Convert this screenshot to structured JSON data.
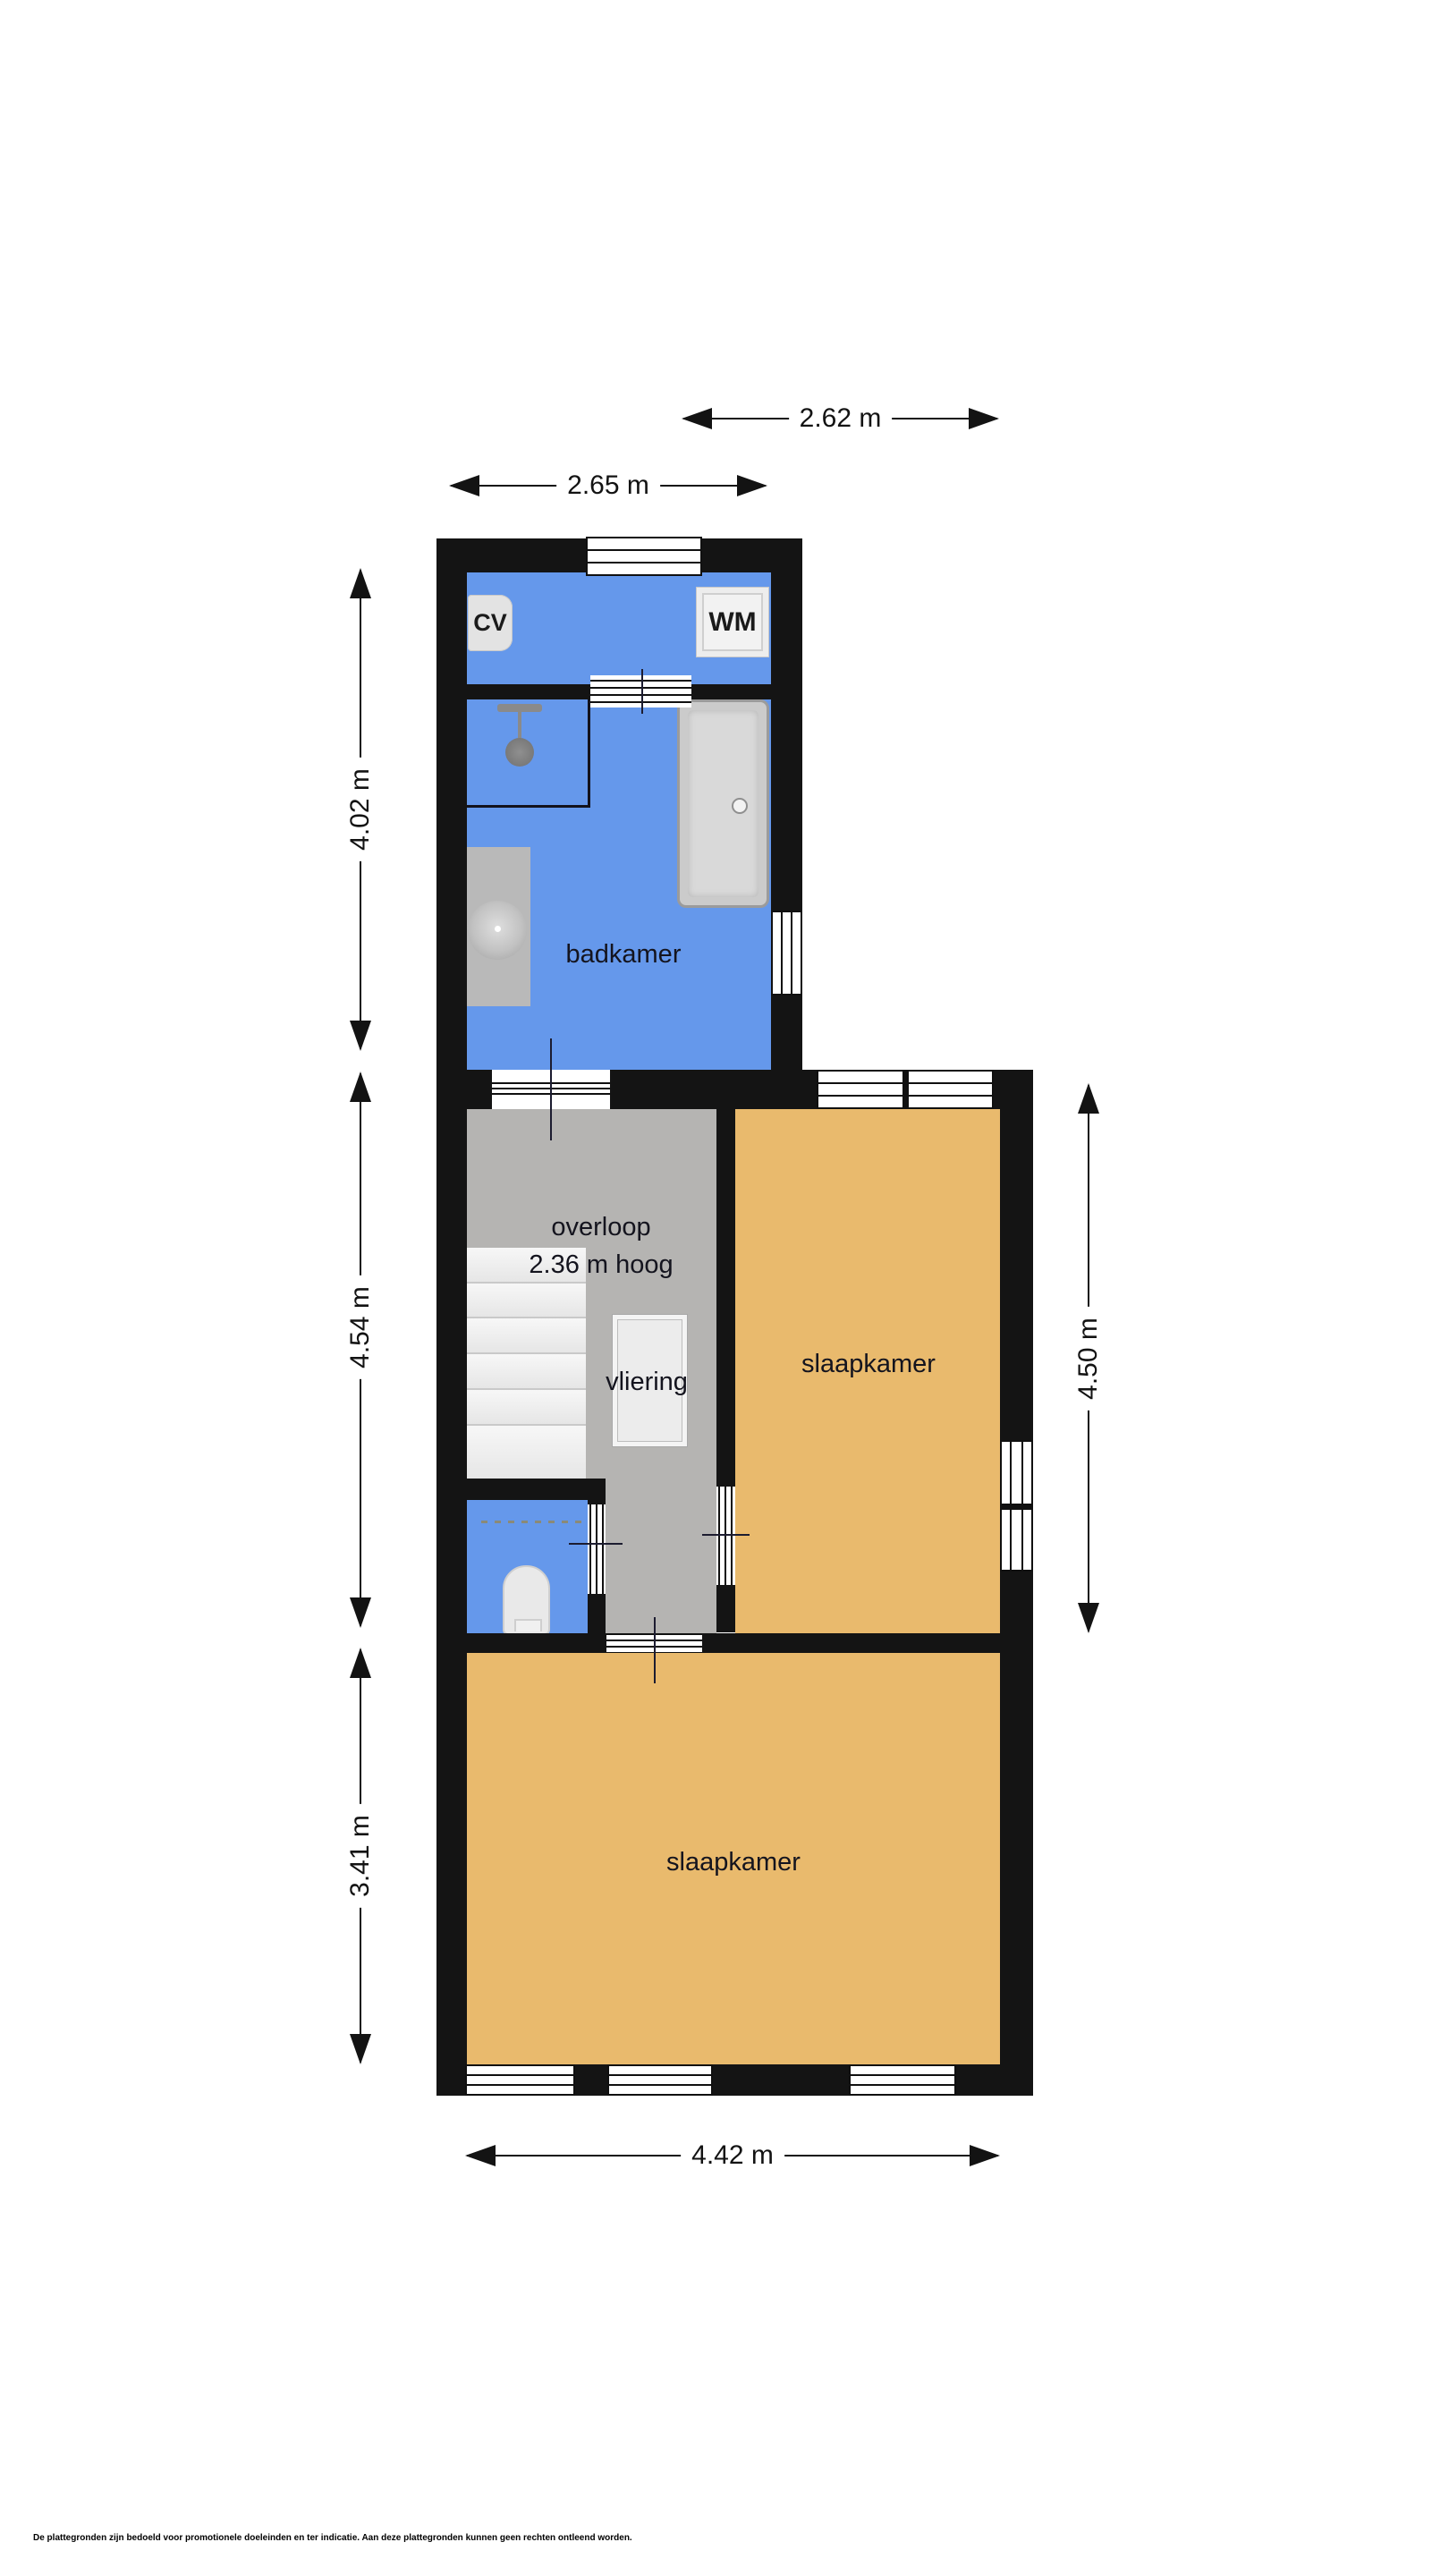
{
  "colors": {
    "wall": "#141414",
    "bathroom_blue": "#6598EB",
    "bedroom_orange": "#E9BA6D",
    "landing_gray": "#B5B4B2",
    "background": "#FFFFFF"
  },
  "rooms": {
    "badkamer": {
      "label": "badkamer"
    },
    "overloop": {
      "label": "overloop",
      "height_note": "2.36 m hoog"
    },
    "vliering": {
      "label": "vliering"
    },
    "bedroom_upper": {
      "label": "slaapkamer"
    },
    "bedroom_lower": {
      "label": "slaapkamer"
    }
  },
  "fixtures": {
    "cv": {
      "label": "CV"
    },
    "wm": {
      "label": "WM"
    }
  },
  "dimensions": {
    "width_upper_right": {
      "label": "2.62 m"
    },
    "width_upper_left": {
      "label": "2.65 m"
    },
    "height_bathroom": {
      "label": "4.02 m"
    },
    "height_landing": {
      "label": "4.54 m"
    },
    "height_bedroom_lower": {
      "label": "3.41 m"
    },
    "height_bedroom_upper": {
      "label": "4.50 m"
    },
    "width_lower": {
      "label": "4.42 m"
    }
  },
  "footer": {
    "disclaimer": "De plattegronden zijn bedoeld voor promotionele doeleinden en ter indicatie. Aan deze plattegronden kunnen geen rechten ontleend worden."
  }
}
